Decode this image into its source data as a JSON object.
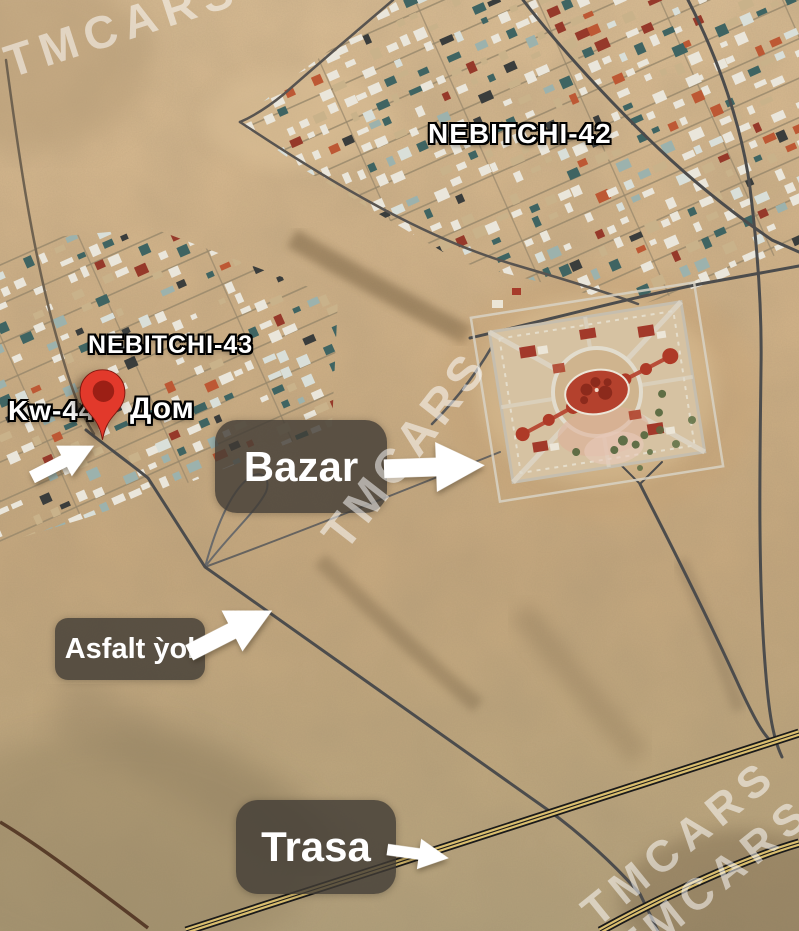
{
  "map": {
    "watermark": "TMCARS",
    "settlements": [
      {
        "label": "NEBITCHI-42"
      },
      {
        "label": "NEBITCHI-43"
      }
    ],
    "pin": {
      "plot_label": "Kw-44",
      "house_label": "Дом"
    },
    "callouts": [
      {
        "label": "Bazar"
      },
      {
        "label": "Asfalt ỳol"
      },
      {
        "label": "Trasa"
      }
    ],
    "colors": {
      "pin": "#e2392b",
      "pin_inner": "#9c1f15",
      "callout_box": "#403b34",
      "arrow": "#ffffff",
      "highway": "#d9bd6e",
      "road": "#4c4c4c",
      "sand": "#cfae85"
    }
  }
}
